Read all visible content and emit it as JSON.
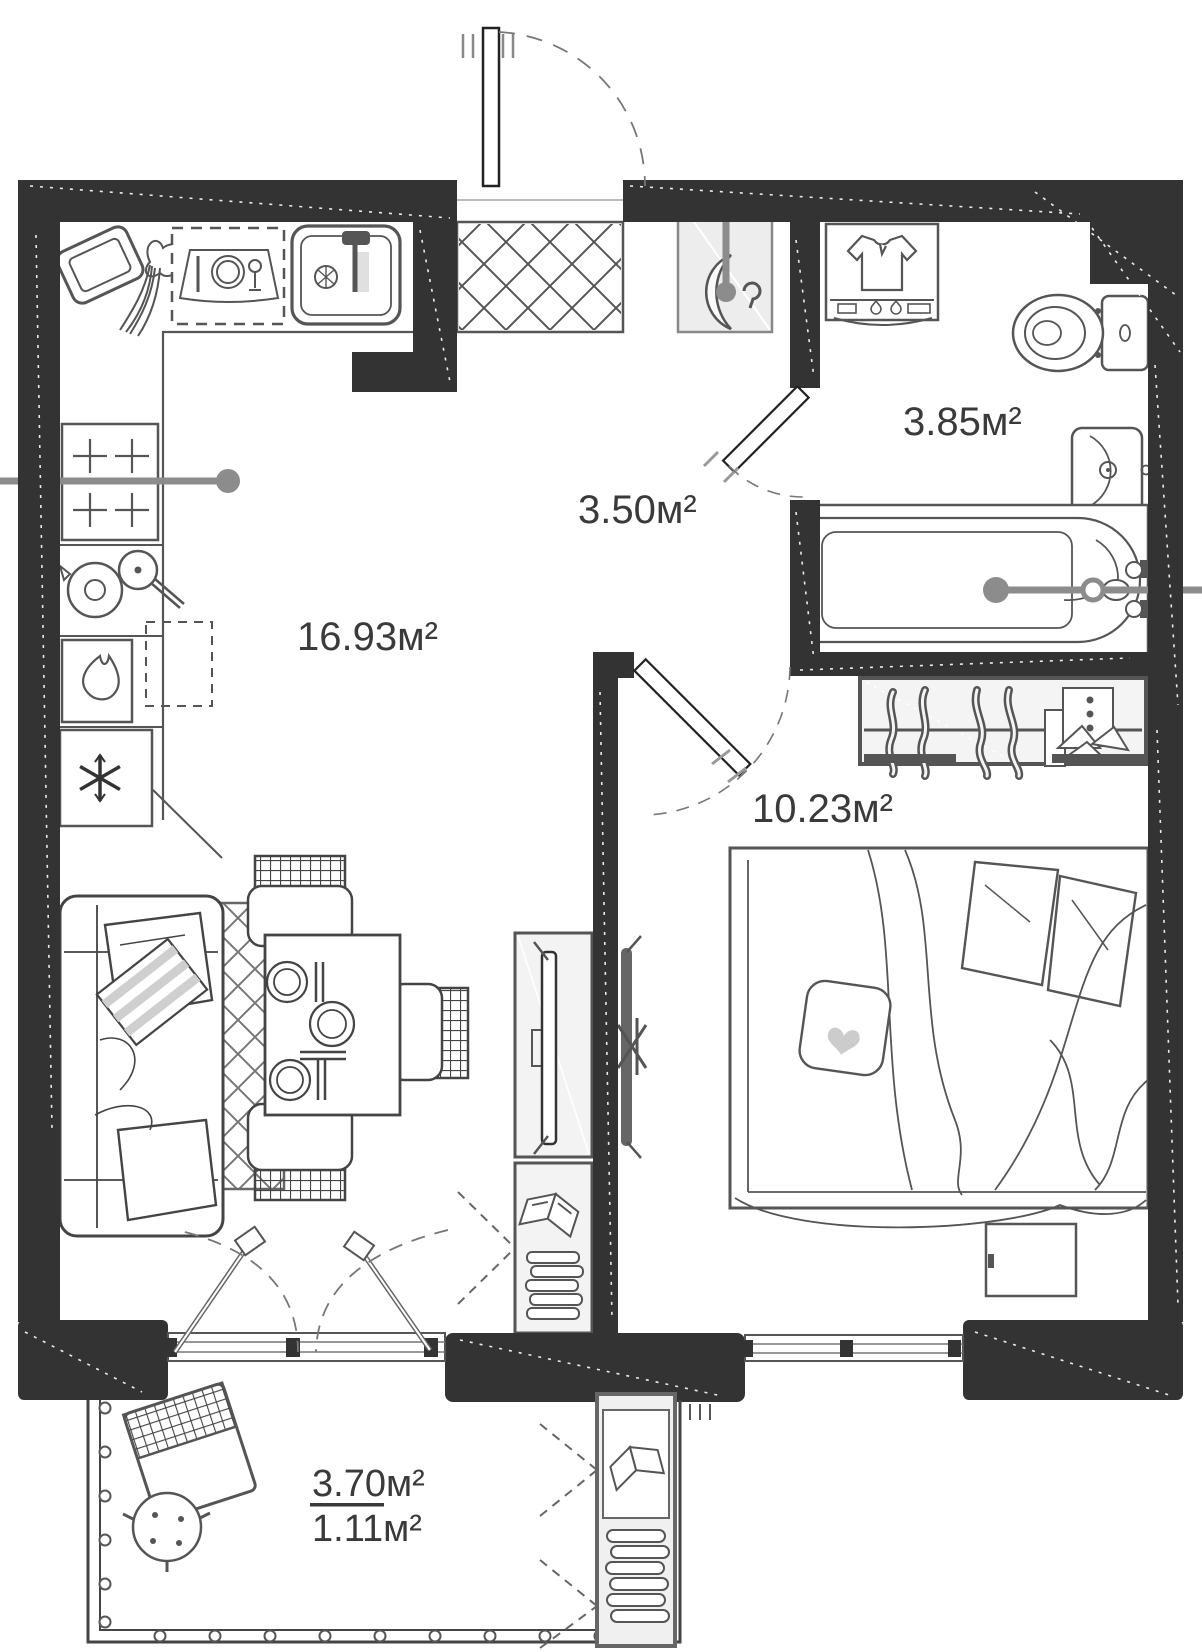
{
  "plan": {
    "type": "apartment-floor-plan",
    "rooms": [
      {
        "id": "kitchen-living-room",
        "label": "16.93м²"
      },
      {
        "id": "hallway",
        "label": "3.50м²"
      },
      {
        "id": "bathroom",
        "label": "3.85м²"
      },
      {
        "id": "bedroom",
        "label": "10.23м²"
      }
    ],
    "balcony": {
      "area_total": "3.70м²",
      "area_reduced": "1.11м²"
    },
    "colors": {
      "wall": "#333333",
      "furniture_outline": "#555555",
      "label_text": "#3a3a3a",
      "shaded_floor": "#ededed",
      "section_line": "#8c8c8c"
    }
  }
}
